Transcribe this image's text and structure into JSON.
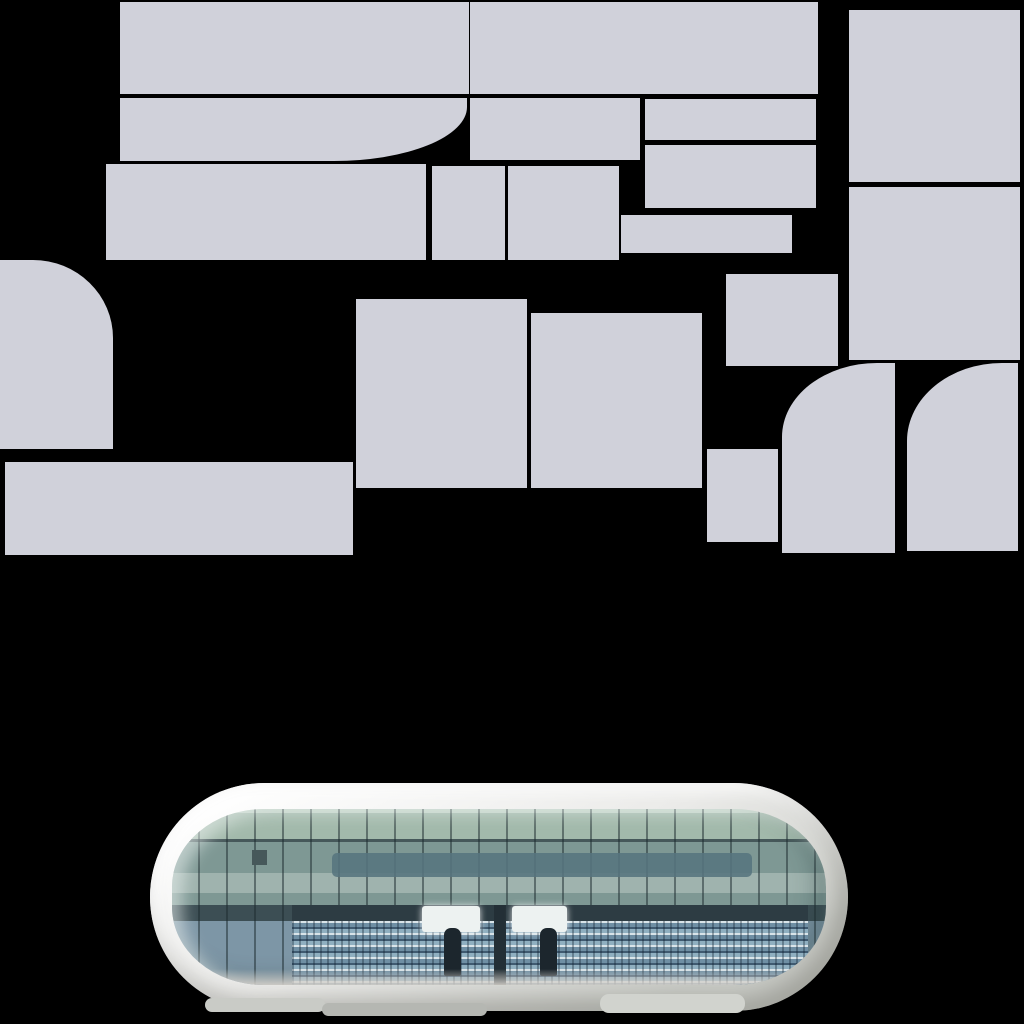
{
  "canvas": {
    "width": 1024,
    "height": 1024,
    "background": "#000000"
  },
  "atlas": {
    "fill": "#d0d1da",
    "tiles": [
      {
        "id": "1",
        "x": 120,
        "y": 2,
        "w": 349,
        "h": 92
      },
      {
        "id": "2",
        "x": 470,
        "y": 2,
        "w": 348,
        "h": 92
      },
      {
        "id": "3",
        "x": 849,
        "y": 10,
        "w": 171,
        "h": 172
      },
      {
        "id": "4",
        "x": 120,
        "y": 98,
        "w": 347,
        "h": 63,
        "corner": "br",
        "rx": 133,
        "ry": 54
      },
      {
        "id": "5",
        "x": 470,
        "y": 98,
        "w": 170,
        "h": 62
      },
      {
        "id": "6",
        "x": 645,
        "y": 99,
        "w": 171,
        "h": 41
      },
      {
        "id": "7",
        "x": 645,
        "y": 145,
        "w": 171,
        "h": 63
      },
      {
        "id": "8",
        "x": 106,
        "y": 164,
        "w": 320,
        "h": 96
      },
      {
        "id": "9",
        "x": 432,
        "y": 166,
        "w": 73,
        "h": 94
      },
      {
        "id": "10",
        "x": 508,
        "y": 166,
        "w": 111,
        "h": 94
      },
      {
        "id": "11",
        "x": 621,
        "y": 215,
        "w": 171,
        "h": 38
      },
      {
        "id": "12",
        "x": 726,
        "y": 274,
        "w": 112,
        "h": 92
      },
      {
        "id": "13",
        "x": 849,
        "y": 187,
        "w": 171,
        "h": 173
      },
      {
        "id": "14",
        "x": 0,
        "y": 260,
        "w": 113,
        "h": 189,
        "corner": "tr",
        "rx": 80,
        "ry": 78
      },
      {
        "id": "15",
        "x": 5,
        "y": 462,
        "w": 348,
        "h": 93
      },
      {
        "id": "16",
        "x": 356,
        "y": 299,
        "w": 171,
        "h": 189
      },
      {
        "id": "17",
        "x": 531,
        "y": 313,
        "w": 171,
        "h": 175
      },
      {
        "id": "18",
        "x": 707,
        "y": 449,
        "w": 71,
        "h": 93
      },
      {
        "id": "19",
        "x": 782,
        "y": 363,
        "w": 113,
        "h": 190,
        "corner": "tl",
        "rx": 95,
        "ry": 74
      },
      {
        "id": "20",
        "x": 907,
        "y": 363,
        "w": 111,
        "h": 188,
        "corner": "tl",
        "rx": 95,
        "ry": 78
      }
    ]
  },
  "mirror": {
    "frame": {
      "x": 150,
      "y": 783,
      "width": 698,
      "height": 228
    },
    "palette": {
      "frame-hi": "#ffffff",
      "frame-mid": "#ebebe9",
      "frame-lo": "#c9cbc6",
      "glass-top-light": "#c3d4c8",
      "glass-upper": "#a2b9ab",
      "glass-line": "#46585a",
      "glass-mid": "#7e9894",
      "glass-walkway": "#9fb3ae",
      "glass-dark-row": "#3c4e54",
      "stand-base": "#7d96a6",
      "band-blue": "#57747e",
      "stand-shadow": "#2d3c43",
      "rail-light": "#d9e4e9",
      "rail-mid": "#6f8fa4",
      "rail-dark": "#3f5a70",
      "rail-blue": "#8fafc0",
      "mullion": "rgba(28,42,46,0.5)",
      "pillar": "#232f36",
      "glare": "#edf2f1",
      "figure": "#1c262d",
      "ground-shadow-dark": "#b5b7b2",
      "ground-shadow-light": "#d1d3ce"
    }
  }
}
